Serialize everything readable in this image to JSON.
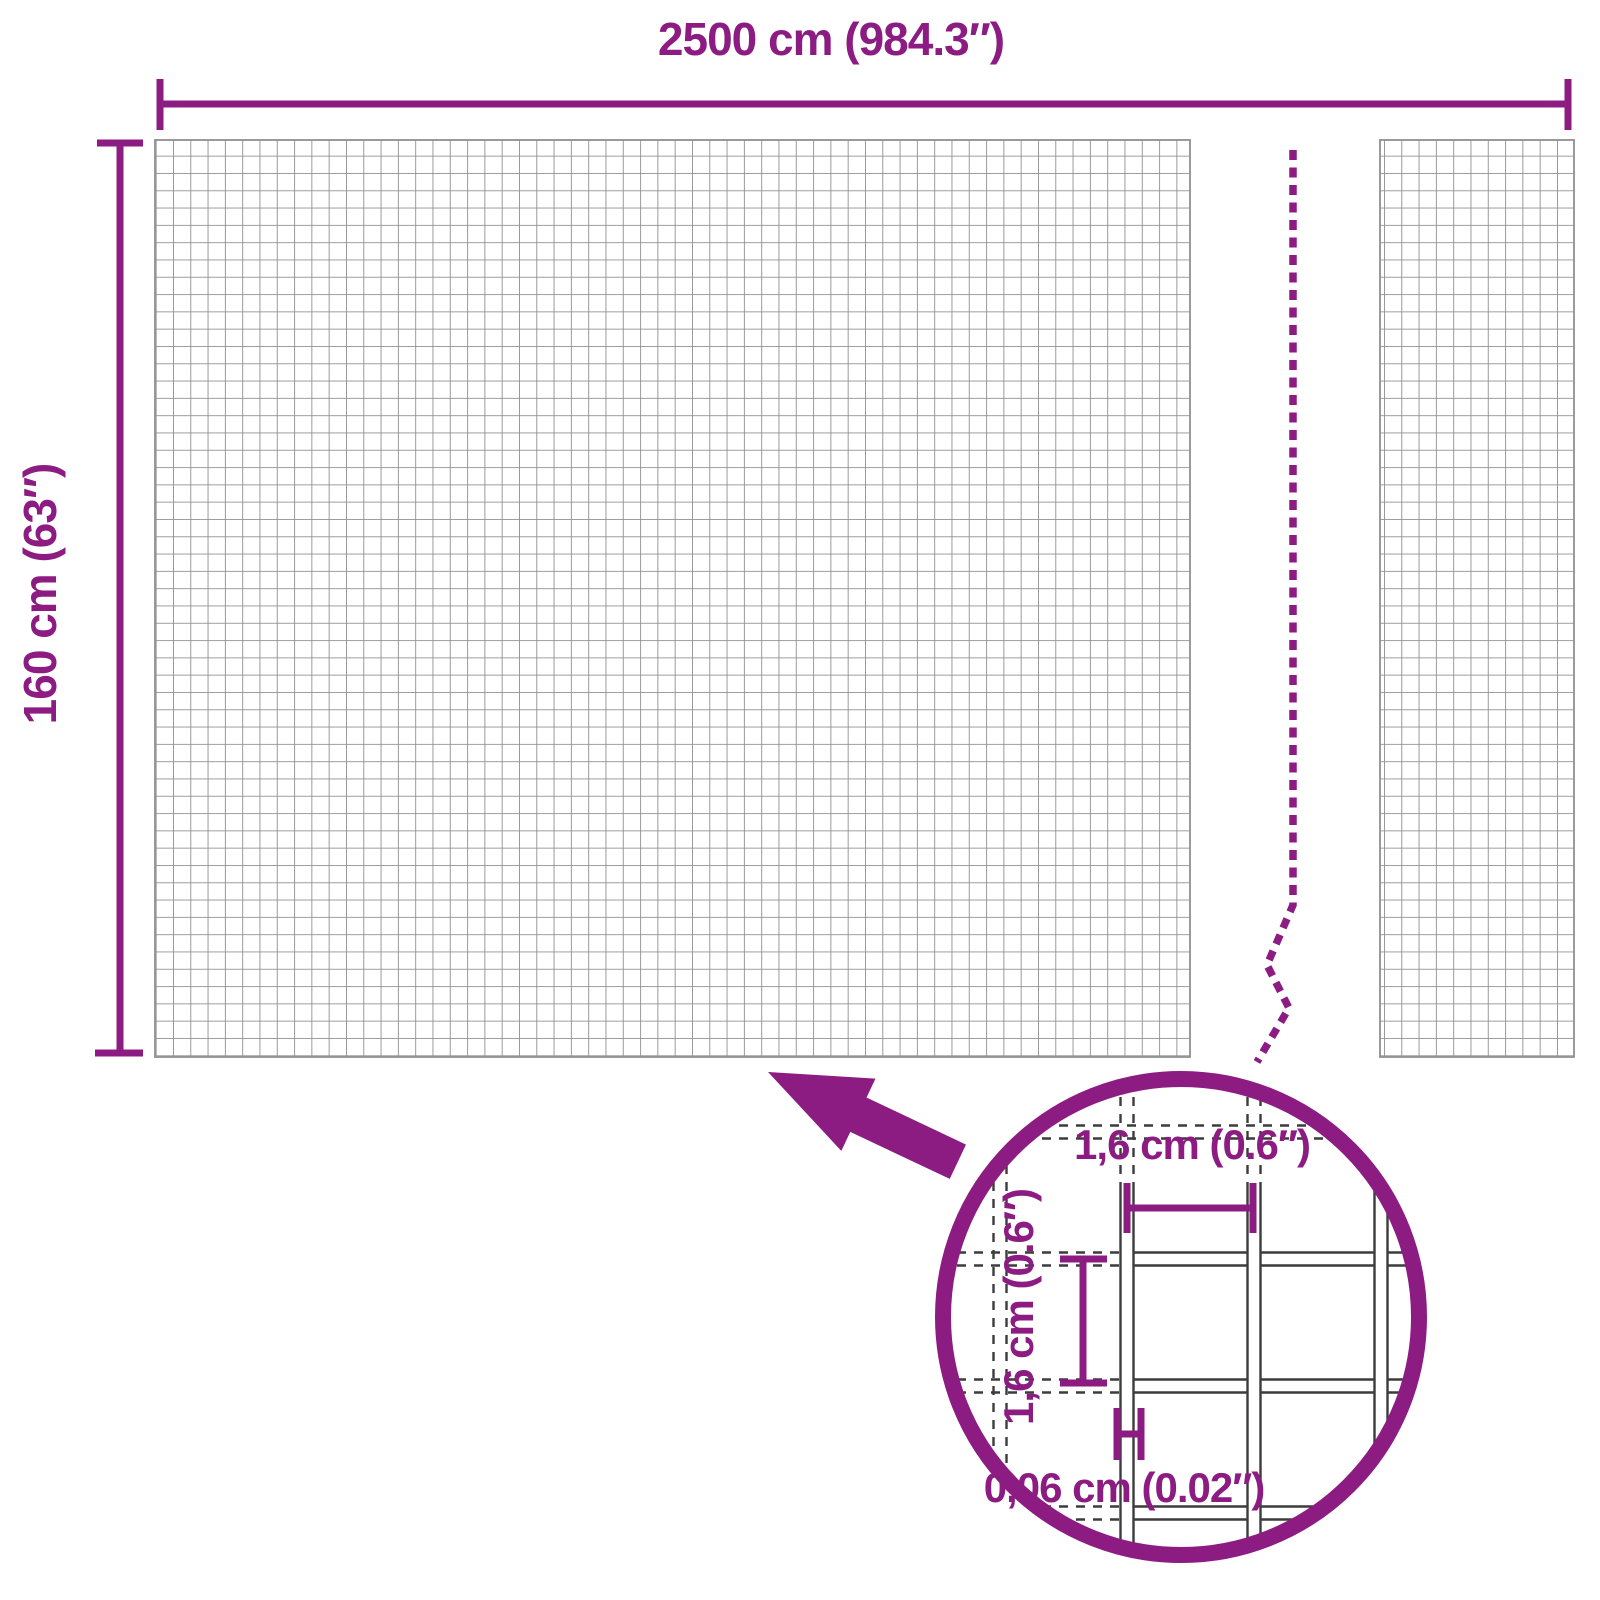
{
  "diagram": {
    "type": "product-dimension-diagram",
    "subject": "wire mesh roll with magnified mesh detail",
    "labels": {
      "total_width": "2500 cm (984.3″)",
      "total_height": "160 cm (63″)",
      "detail_width": "1,6 cm (0.6″)",
      "detail_height": "1,6 cm (0.6″)",
      "detail_wire": "0,06 cm (0.02″)"
    },
    "colors": {
      "accent": "#8c1c82",
      "mesh_grid": "#909090",
      "detail_wire_line": "#3c3c3c",
      "background": "#ffffff"
    },
    "icons": {
      "zoom_arrow": "arrow-icon",
      "magnifier_circle": "zoom-circle-icon",
      "roll_break": "break-line"
    }
  }
}
